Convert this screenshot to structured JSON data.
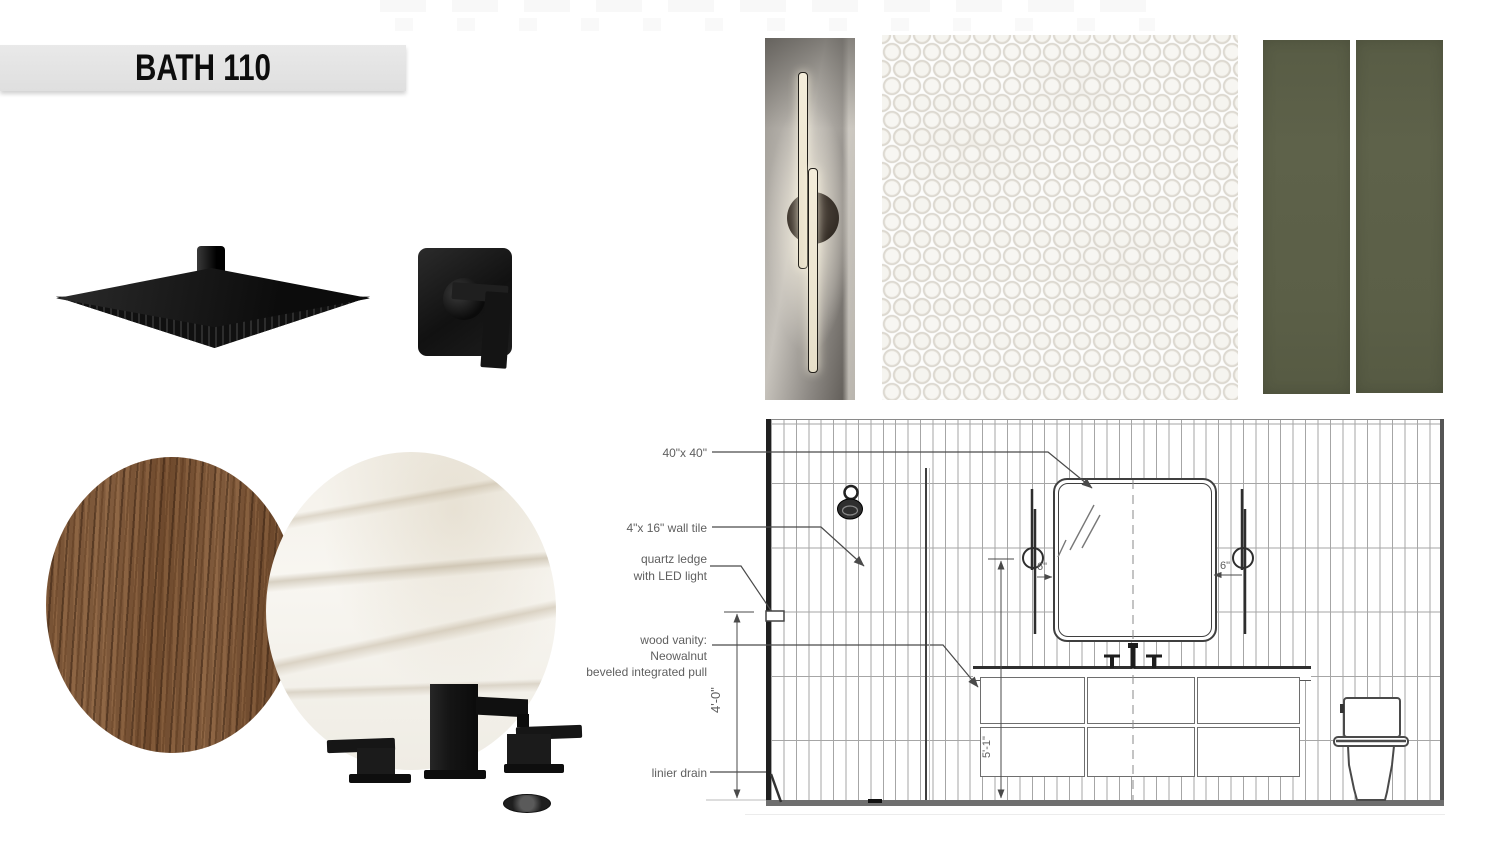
{
  "header": {
    "room_label": "BATH 110"
  },
  "elevation": {
    "callouts": {
      "mirror_size": "40\"x 40\"",
      "wall_tile": "4\"x 16\" wall tile",
      "quartz_ledge": "quartz ledge\nwith LED light",
      "vanity": "wood vanity:\nNeowalnut\nbeveled integrated pull",
      "drain": "linier drain"
    },
    "dimensions": {
      "left_height": "4'-0\"",
      "center_height": "5'-1\"",
      "sconce_gap_left": "6\"",
      "sconce_gap_right": "6\""
    }
  },
  "colors": {
    "tile_green": "#5d6149",
    "fixture_black": "#141414",
    "wood_brown": "#7b573a",
    "quartz_white": "#f4f1ea",
    "drawing_line": "#4a4a4a",
    "banner_gray": "#e4e4e4"
  }
}
